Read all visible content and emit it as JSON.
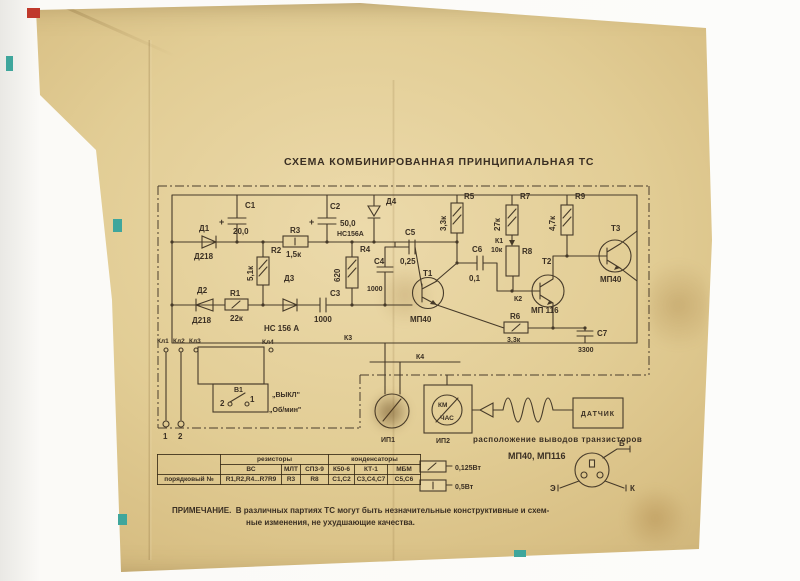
{
  "title": "СХЕМА КОМБИНИРОВАННАЯ ПРИНЦИПИАЛЬНАЯ ТС",
  "labels": {
    "d1": "Д1",
    "d1t": "Д218",
    "d2": "Д2",
    "d2t": "Д218",
    "d3": "Д3",
    "d4": "Д4",
    "r1": "R1",
    "r1v": "22к",
    "r2": "R2",
    "r2v": "5,1к",
    "r3": "R3",
    "r3v": "1,5к",
    "r4": "R4",
    "r4v": "620",
    "r5": "R5",
    "r5v": "3,3к",
    "r6": "R6",
    "r6v": "3,3к",
    "r7": "R7",
    "r7v": "27к",
    "r8": "R8",
    "r8v": "10к",
    "r9": "R9",
    "r9v": "4,7к",
    "c1": "С1",
    "c1v": "20,0",
    "c2": "С2",
    "c2v": "50,0",
    "c3": "С3",
    "c3v": "1000",
    "c4": "С4",
    "c4v": "1000",
    "c5": "С5",
    "c5v": "0,25",
    "c6": "С6",
    "c6v": "0,1",
    "c7": "С7",
    "c7v": "3300",
    "plus": "+",
    "hc_top": "НС156А",
    "hc_bottom": "НС 156 А",
    "t1": "Т1",
    "t1t": "МП40",
    "t2": "Т2",
    "t2t": "МП 116",
    "t3": "Т3",
    "t3t": "МП40",
    "k1": "К1",
    "k2": "К2",
    "k3": "К3",
    "k4": "К4",
    "kl1": "Кл1",
    "kl2": "Кл2",
    "kl3": "Кл3",
    "kl4": "Кл4",
    "term1": "1",
    "term2": "2",
    "sw": "В1",
    "sw_pos1": "1",
    "sw_pos2": "2",
    "sw_off": "„ВЫКЛ\"",
    "sw_on": "„Об/мин\"",
    "ip1": "ИП1",
    "ip2": "ИП2",
    "dial_top": "КМ",
    "dial_bottom": "ЧАС",
    "sensor": "ДАТЧИК",
    "pinout_caption": "расположение выводов транзисторов",
    "pinout_types": "МП40, МП116",
    "pin_b": "Б",
    "pin_e": "Э",
    "pin_k": "К"
  },
  "power": {
    "p125": "0,125Вт",
    "p05": "0,5Вт"
  },
  "table": {
    "group_resistors": "резисторы",
    "group_capacitors": "конденсаторы",
    "row_label": "порядковый №",
    "types": [
      "ВС",
      "МЛТ",
      "СП3-9",
      "К50-6",
      "КТ-1",
      "МБМ"
    ],
    "items": [
      "R1,R2,R4...R7R9",
      "R3",
      "R8",
      "С1,С2",
      "С3,С4,С7",
      "С5,С6"
    ]
  },
  "note": {
    "heading": "ПРИМЕЧАНИЕ.",
    "line1": "В различных партиях ТС могут быть незначительные конструктивные и схем-",
    "line2": "ные изменения, не ухудшающие качества."
  },
  "colors": {
    "paper": "#e2cd95",
    "ink": "#463a29",
    "red_mark": "#c0392b",
    "teal_mark": "#3fa69c"
  }
}
